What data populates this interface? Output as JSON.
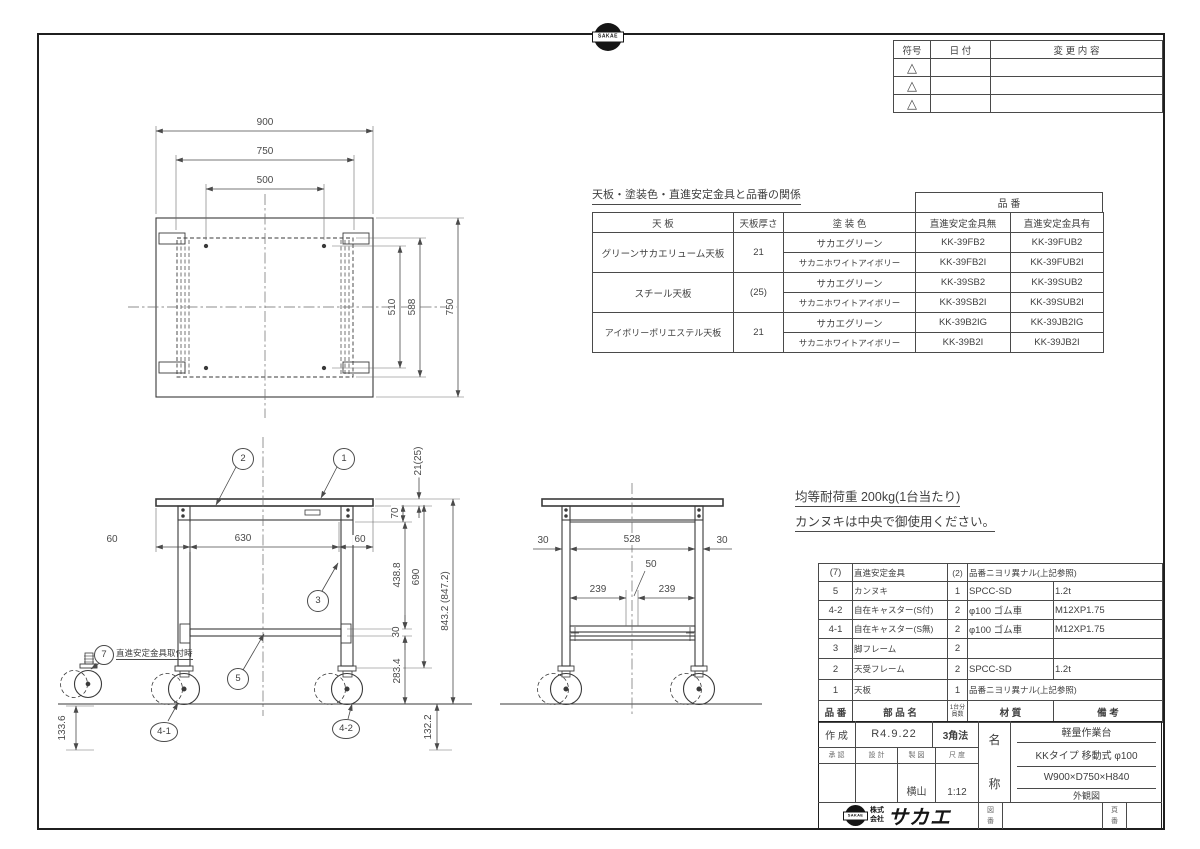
{
  "stamp": {
    "label": "SAKAE"
  },
  "revision_table": {
    "header_symbol": "符号",
    "header_date": "日  付",
    "header_change": "変  更  内  容",
    "triangle": "△"
  },
  "product_table": {
    "title": "天板・塗装色・直進安定金具と品番の関係",
    "part_no_group": "品  番",
    "header_top": "天  板",
    "header_thickness": "天板厚さ",
    "header_color": "塗  装  色",
    "header_without": "直進安定金具無",
    "header_with": "直進安定金具有",
    "groups": [
      {
        "top": "グリーンサカエリューム天板",
        "thickness": "21",
        "rows": [
          {
            "color": "サカエグリーン",
            "without": "KK-39FB2",
            "with": "KK-39FUB2"
          },
          {
            "color": "サカニホワイトアイボリー",
            "without": "KK-39FB2I",
            "with": "KK-39FUB2I"
          }
        ]
      },
      {
        "top": "スチール天板",
        "thickness": "(25)",
        "rows": [
          {
            "color": "サカエグリーン",
            "without": "KK-39SB2",
            "with": "KK-39SUB2"
          },
          {
            "color": "サカニホワイトアイボリー",
            "without": "KK-39SB2I",
            "with": "KK-39SUB2I"
          }
        ]
      },
      {
        "top": "アイボリーポリエステル天板",
        "thickness": "21",
        "rows": [
          {
            "color": "サカエグリーン",
            "without": "KK-39B2IG",
            "with": "KK-39JB2IG"
          },
          {
            "color": "サカニホワイトアイボリー",
            "without": "KK-39B2I",
            "with": "KK-39JB2I"
          }
        ]
      }
    ]
  },
  "notes": {
    "load": "均等耐荷重  200kg(1台当たり)",
    "kannuki": "カンヌキは中央で御使用ください。"
  },
  "top_view": {
    "dim_900": "900",
    "dim_750_h": "750",
    "dim_500": "500",
    "dim_510": "510",
    "dim_588": "588",
    "dim_750_v": "750"
  },
  "front_view": {
    "dim_thickness": "21(25)",
    "dim_70": "70",
    "dim_left60": "60",
    "dim_630": "630",
    "dim_right60": "60",
    "dim_4388": "438.8",
    "dim_690": "690",
    "dim_30": "30",
    "dim_2834": "283.4",
    "dim_total": "843.2 (847.2)",
    "dim_1336": "133.6",
    "dim_1322": "132.2",
    "balloon_1": "1",
    "balloon_2": "2",
    "balloon_3": "3",
    "balloon_5": "5",
    "balloon_7": "7",
    "balloon_41": "4-1",
    "balloon_42": "4-2",
    "note_7": "直進安定金具取付時"
  },
  "side_view": {
    "dim_left30": "30",
    "dim_528": "528",
    "dim_right30": "30",
    "dim_50": "50",
    "dim_239_l": "239",
    "dim_239_r": "239"
  },
  "parts_table": {
    "header_no": "品 番",
    "header_name": "部  品  名",
    "header_qty_top": "1台分",
    "header_qty_bottom": "員数",
    "header_material": "材    質",
    "header_remarks": "備    考",
    "rows": [
      {
        "no": "(7)",
        "name": "直進安定金具",
        "qty": "(2)",
        "material": "品番ニヨリ異ナル(上記参照)",
        "remarks": ""
      },
      {
        "no": "5",
        "name": "カンヌキ",
        "qty": "1",
        "material": "SPCC-SD",
        "remarks": "1.2t"
      },
      {
        "no": "4-2",
        "name": "自在キャスター(S付)",
        "qty": "2",
        "material": "φ100 ゴム車",
        "remarks": "M12XP1.75"
      },
      {
        "no": "4-1",
        "name": "自在キャスター(S無)",
        "qty": "2",
        "material": "φ100 ゴム車",
        "remarks": "M12XP1.75"
      },
      {
        "no": "3",
        "name": "脚フレーム",
        "qty": "2",
        "material": "",
        "remarks": ""
      },
      {
        "no": "2",
        "name": "天受フレーム",
        "qty": "2",
        "material": "SPCC-SD",
        "remarks": "1.2t"
      },
      {
        "no": "1",
        "name": "天板",
        "qty": "1",
        "material": "品番ニヨリ異ナル(上記参照)",
        "remarks": ""
      }
    ]
  },
  "title_block": {
    "created_label": "作 成",
    "created_value": "R4.9.22",
    "projection": "3角法",
    "approve_label": "承  認",
    "design_label": "設  計",
    "draft_label": "製  図",
    "scale_label": "尺  度",
    "draft_value": "横山",
    "scale_value": "1:12",
    "name_char_1": "名",
    "name_char_2": "称",
    "name_lines": [
      "軽量作業台",
      "KKタイプ 移動式 φ100",
      "W900×D750×H840",
      "外観図"
    ],
    "company_prefix_1": "株式",
    "company_prefix_2": "会社",
    "company_name": "サカエ",
    "drawing_no_char_1": "図",
    "drawing_no_char_2": "番",
    "page_no_char_1": "頁",
    "page_no_char_2": "番"
  }
}
